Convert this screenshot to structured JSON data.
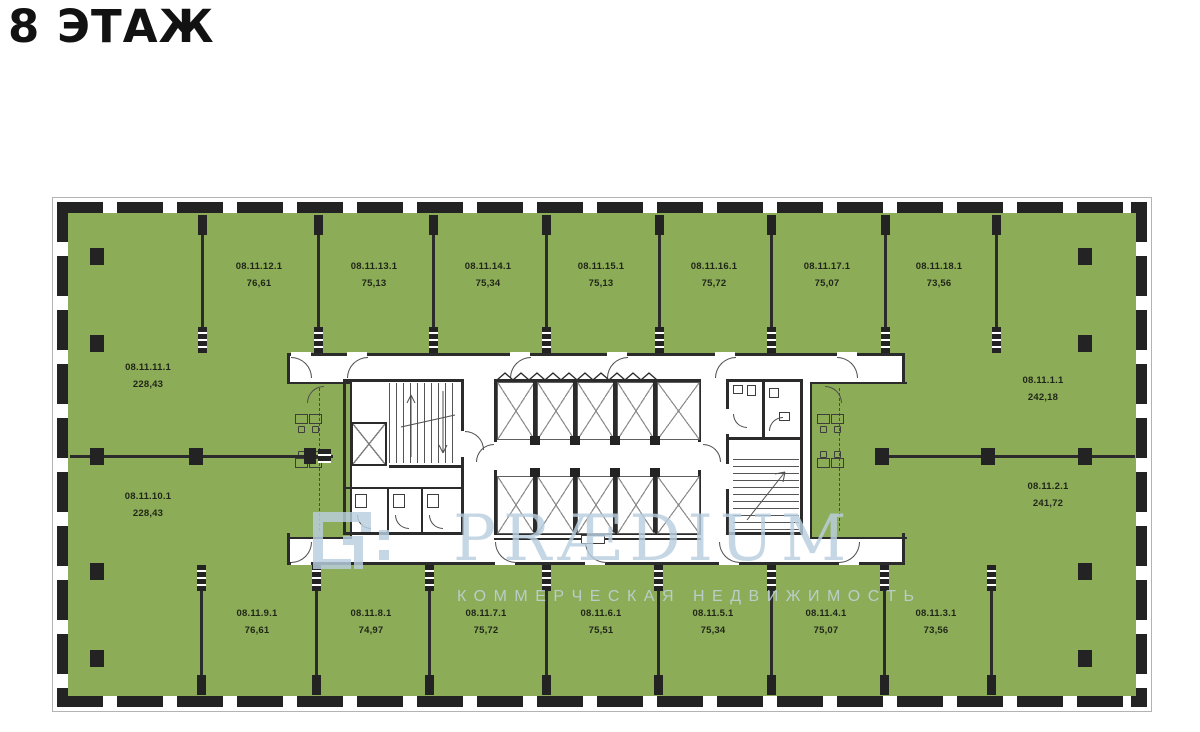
{
  "title": "8 ЭТАЖ",
  "watermark": {
    "brand": "PRÆDIUM",
    "subtitle": "КОММЕРЧЕСКАЯ НЕДВИЖИМОСТЬ",
    "logo_icon": "praedium-logo-icon"
  },
  "colors": {
    "unit_fill": "#8dac57",
    "walls": "#2b2b2b",
    "facade": "#232323",
    "watermark_blue": "#b9cfdf"
  },
  "floor_plan": {
    "floor_label": "8",
    "groups": {
      "top": [
        {
          "id": "08.11.12.1",
          "area": "76,61"
        },
        {
          "id": "08.11.13.1",
          "area": "75,13"
        },
        {
          "id": "08.11.14.1",
          "area": "75,34"
        },
        {
          "id": "08.11.15.1",
          "area": "75,13"
        },
        {
          "id": "08.11.16.1",
          "area": "75,72"
        },
        {
          "id": "08.11.17.1",
          "area": "75,07"
        },
        {
          "id": "08.11.18.1",
          "area": "73,56"
        }
      ],
      "left": [
        {
          "id": "08.11.11.1",
          "area": "228,43"
        },
        {
          "id": "08.11.10.1",
          "area": "228,43"
        }
      ],
      "right": [
        {
          "id": "08.11.1.1",
          "area": "242,18"
        },
        {
          "id": "08.11.2.1",
          "area": "241,72"
        }
      ],
      "bottom": [
        {
          "id": "08.11.9.1",
          "area": "76,61"
        },
        {
          "id": "08.11.8.1",
          "area": "74,97"
        },
        {
          "id": "08.11.7.1",
          "area": "75,72"
        },
        {
          "id": "08.11.6.1",
          "area": "75,51"
        },
        {
          "id": "08.11.5.1",
          "area": "75,34"
        },
        {
          "id": "08.11.4.1",
          "area": "75,07"
        },
        {
          "id": "08.11.3.1",
          "area": "73,56"
        }
      ]
    }
  }
}
